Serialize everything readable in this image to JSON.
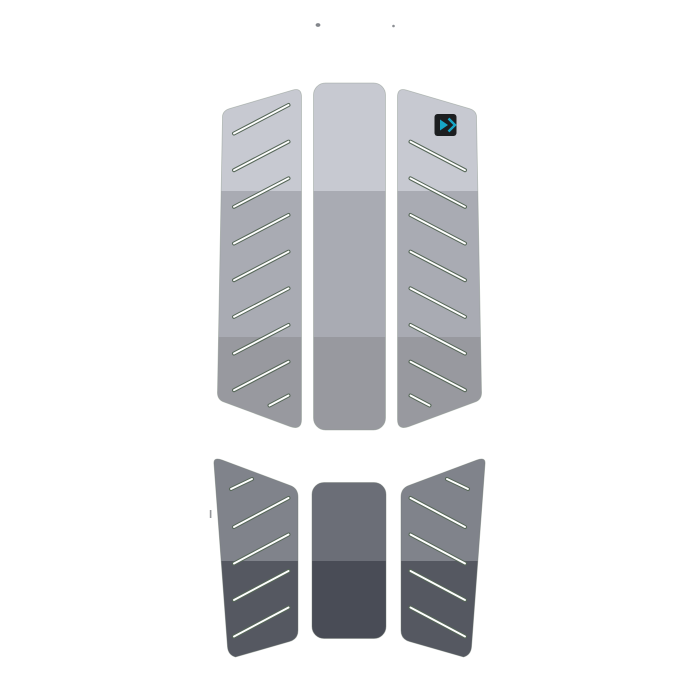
{
  "meta": {
    "description": "Product image of a three-piece traction deck pad with diagonal grip slits, brand logo chip, and a floor reflection",
    "background": "#ffffff"
  },
  "pad": {
    "band_colors": {
      "top": "#c7c9d1",
      "middle": "#a9abb3",
      "bottom": "#98999f"
    },
    "panel_edge": "#8e998f",
    "slit": {
      "outline": "#566758",
      "fill": "#ffffff"
    }
  },
  "reflection": {
    "outer_upper": "#80838b",
    "outer_lower": "#555861",
    "center_upper": "#6b6e77",
    "center_lower": "#494c56",
    "panel_edge": "#6f7a71"
  },
  "logo": {
    "icon": "duotone-arrow-logo-icon",
    "chip_color": "#1c1e20",
    "glyph_color": "#17a6c6"
  },
  "artifacts": {
    "speck_color": "#83868b",
    "speck_color_small": "#8b8e93",
    "tick_color": "#7a7d82"
  }
}
